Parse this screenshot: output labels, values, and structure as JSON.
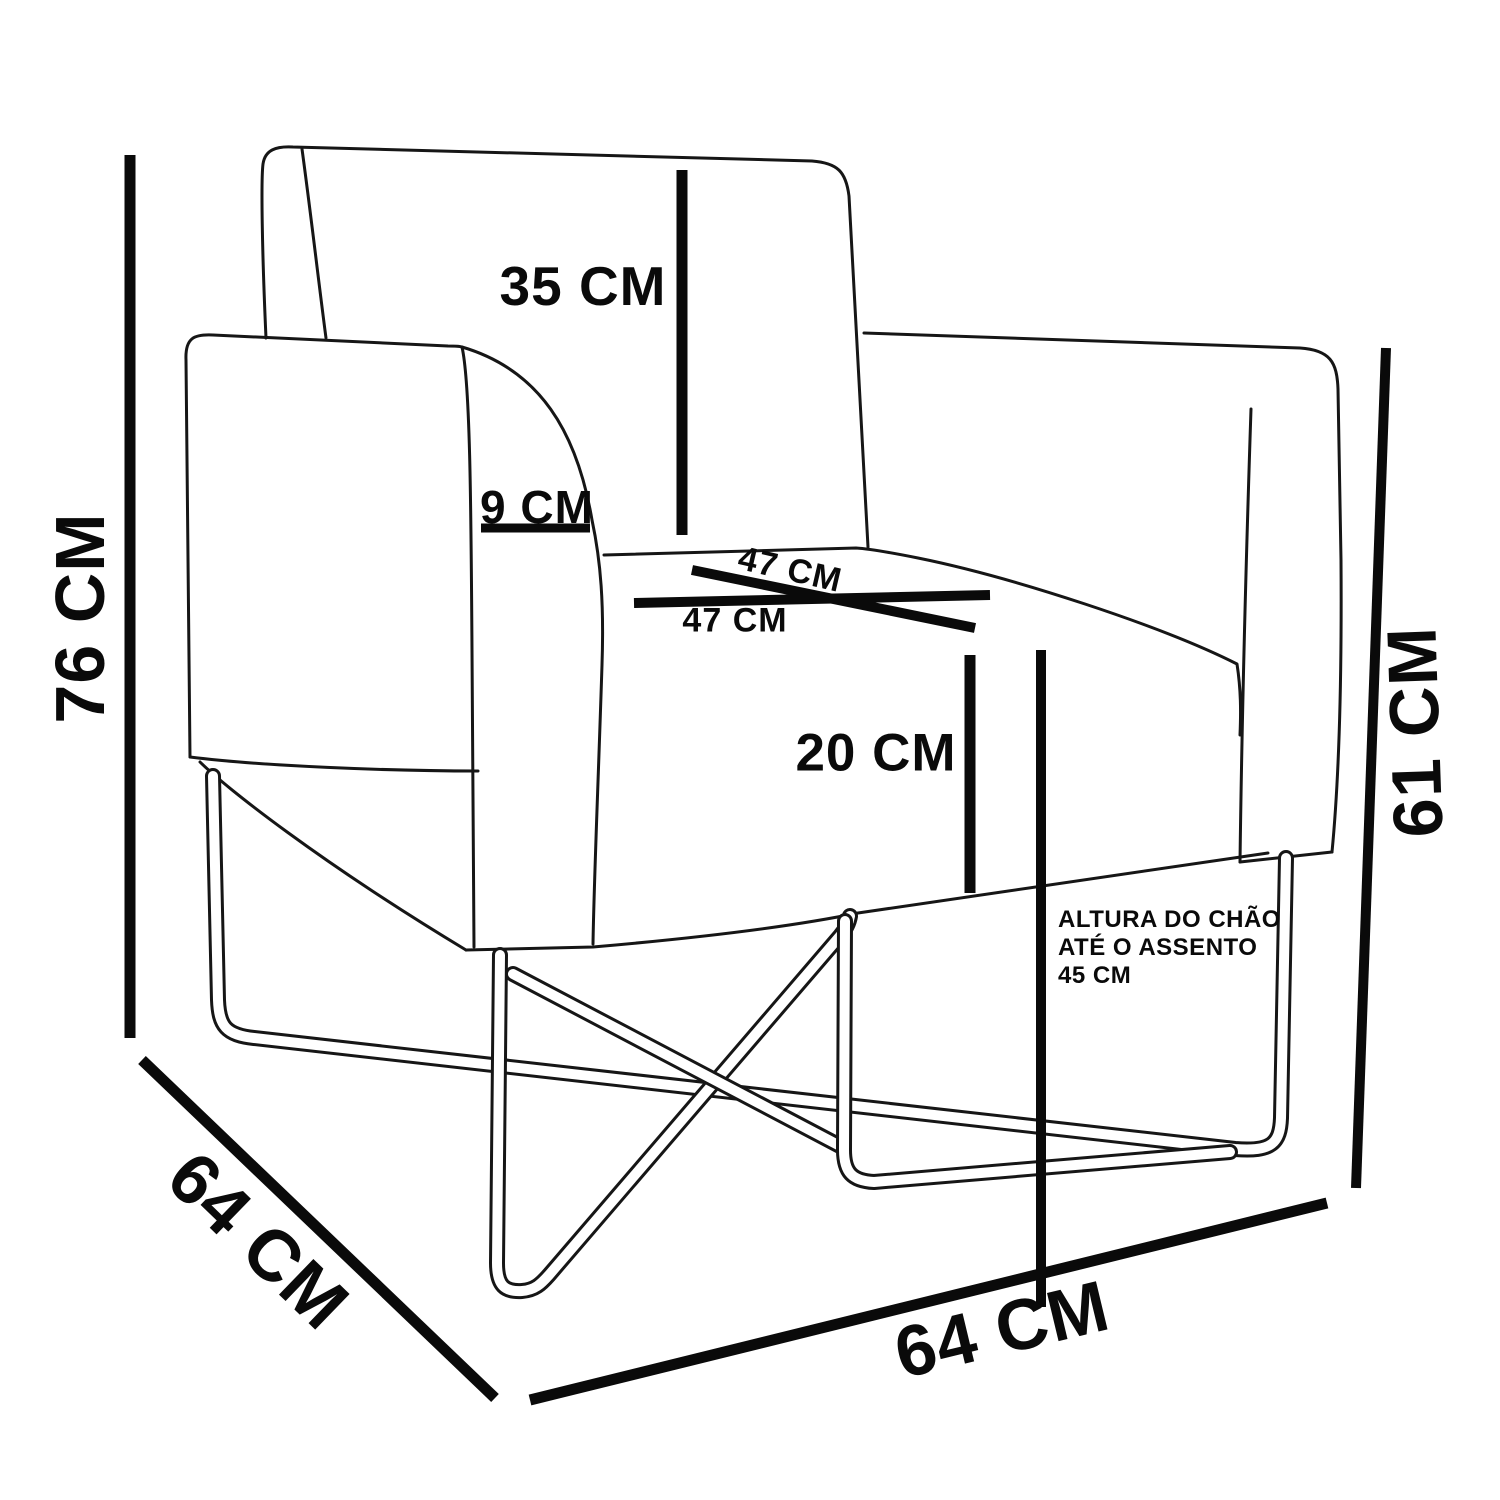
{
  "diagram": {
    "subject": "armchair with metal x-frame base, dimension drawing",
    "unit": "CM",
    "colors": {
      "background": "#ffffff",
      "outline": "#161616",
      "dimension": "#0a0a0a",
      "text": "#0a0a0a"
    },
    "measurements": {
      "total_height": {
        "label": "76 CM",
        "value": 76,
        "unit": "CM"
      },
      "backrest_height": {
        "label": "35 CM",
        "value": 35,
        "unit": "CM"
      },
      "armrest_thickness": {
        "label": "9 CM",
        "value": 9,
        "unit": "CM"
      },
      "seat_depth": {
        "label": "47 CM",
        "value": 47,
        "unit": "CM"
      },
      "seat_width": {
        "label": "47 CM",
        "value": 47,
        "unit": "CM"
      },
      "cushion_height": {
        "label": "20 CM",
        "value": 20,
        "unit": "CM"
      },
      "arm_height": {
        "label": "61 CM",
        "value": 61,
        "unit": "CM"
      },
      "depth": {
        "label": "64 CM",
        "value": 64,
        "unit": "CM"
      },
      "width": {
        "label": "64 CM",
        "value": 64,
        "unit": "CM"
      },
      "floor_to_seat": {
        "value": 45,
        "unit": "CM",
        "note": [
          "ALTURA DO CHÃO",
          "ATÉ O ASSENTO",
          "45 CM"
        ]
      }
    }
  }
}
